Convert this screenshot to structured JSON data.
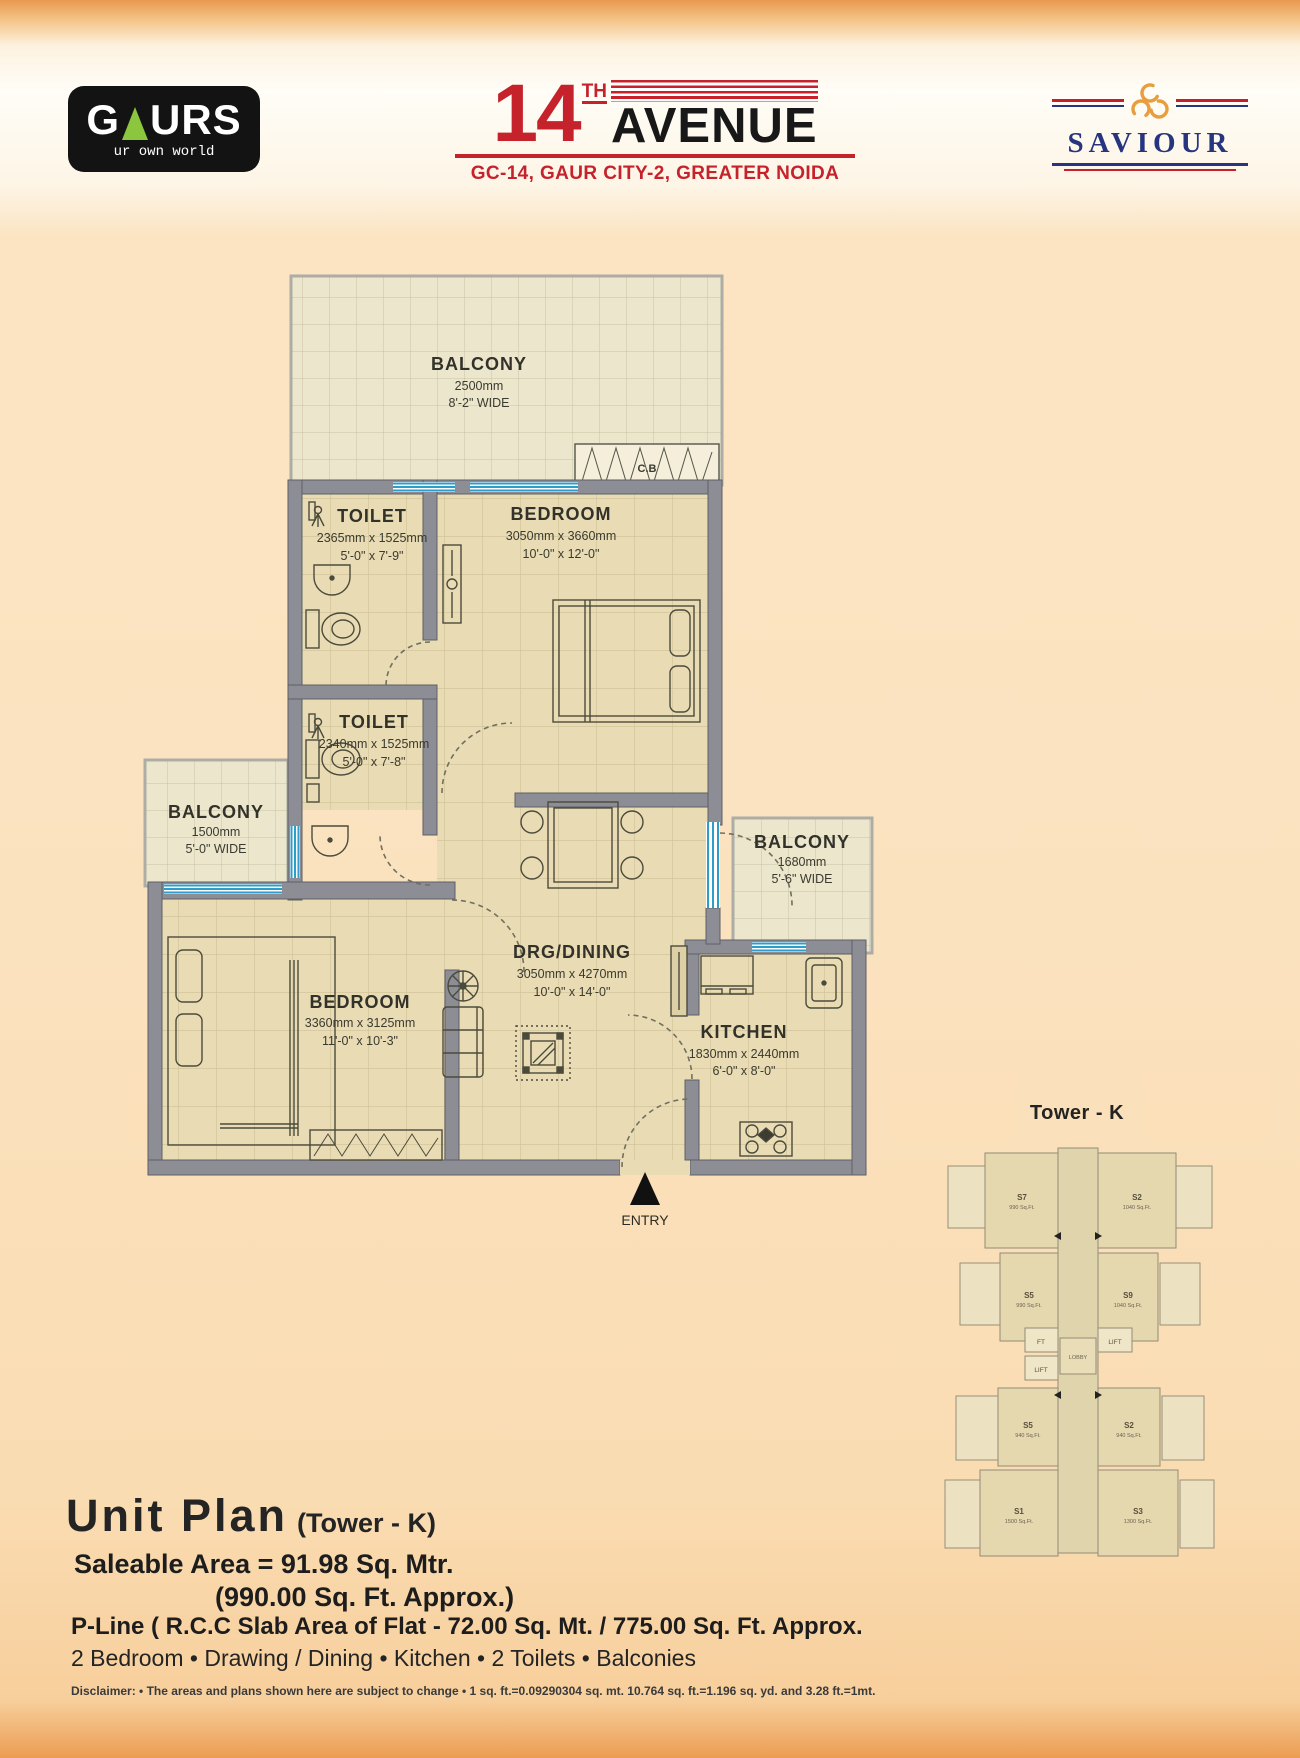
{
  "header": {
    "gaurs": {
      "part1": "G",
      "part2": "URS",
      "tagline": "ur own world"
    },
    "avenue": {
      "number": "14",
      "ordinal": "TH",
      "word": "AVENUE",
      "tagline": "GC-14, GAUR CITY-2, GREATER NOIDA"
    },
    "saviour": {
      "word": "SAVIOUR"
    }
  },
  "plan": {
    "rooms": [
      {
        "label": "BALCONY",
        "dim_mm": "2500mm",
        "dim_ft": "8'-2\" WIDE"
      },
      {
        "label": "TOILET",
        "dim_mm": "2365mm x 1525mm",
        "dim_ft": "5'-0\" x 7'-9\""
      },
      {
        "label": "BEDROOM",
        "dim_mm": "3050mm x 3660mm",
        "dim_ft": "10'-0\" x 12'-0\""
      },
      {
        "label": "TOILET",
        "dim_mm": "2340mm x 1525mm",
        "dim_ft": "5'-0\" x 7'-8\""
      },
      {
        "label": "BALCONY",
        "dim_mm": "1500mm",
        "dim_ft": "5'-0\" WIDE"
      },
      {
        "label": "BEDROOM",
        "dim_mm": "3360mm x 3125mm",
        "dim_ft": "11'-0\" x 10'-3\""
      },
      {
        "label": "DRG/DINING",
        "dim_mm": "3050mm x 4270mm",
        "dim_ft": "10'-0\" x 14'-0\""
      },
      {
        "label": "BALCONY",
        "dim_mm": "1680mm",
        "dim_ft": "5'-6\" WIDE"
      },
      {
        "label": "KITCHEN",
        "dim_mm": "1830mm x 2440mm",
        "dim_ft": "6'-0\" x 8'-0\""
      }
    ],
    "entry_label": "ENTRY",
    "cupboard_label": "C.B"
  },
  "key_plan": {
    "title": "Tower - K",
    "units": [
      {
        "code": "S7",
        "area": "990 Sq.Ft."
      },
      {
        "code": "S2",
        "area": "1040 Sq.Ft."
      },
      {
        "code": "S5",
        "area": "990 Sq.Ft."
      },
      {
        "code": "S9",
        "area": "1040 Sq.Ft."
      },
      {
        "code": "S5",
        "area": "940 Sq.Ft."
      },
      {
        "code": "S2",
        "area": "940 Sq.Ft."
      },
      {
        "code": "S1",
        "area": "1500 Sq.Ft."
      },
      {
        "code": "S3",
        "area": "1300 Sq.Ft."
      }
    ],
    "services": {
      "ft": "FT",
      "lift1": "LIFT",
      "lift2": "LIFT",
      "lobby": "LOBBY"
    }
  },
  "details": {
    "title": "Unit Plan",
    "tower": "(Tower - K)",
    "area_line1": "Saleable Area = 91.98 Sq. Mtr.",
    "area_line2": "(990.00 Sq. Ft. Approx.)",
    "pline": "P-Line ( R.C.C Slab Area of Flat  - 72.00  Sq. Mt. / 775.00 Sq. Ft. Approx.",
    "features": "2 Bedroom  • Drawing / Dining • Kitchen • 2 Toilets • Balconies",
    "disclaimer": "Disclaimer: • The areas and plans shown here are subject to change • 1 sq. ft.=0.09290304 sq. mt. 10.764 sq. ft.=1.196 sq. yd. and 3.28 ft.=1mt."
  },
  "colors": {
    "brand_red": "#c6222b",
    "brand_green": "#8cc63e",
    "saviour_navy": "#26357e",
    "saviour_orange": "#e89e3e",
    "wall_gray": "#8d8d95",
    "window_blue": "#2f9dc9"
  }
}
